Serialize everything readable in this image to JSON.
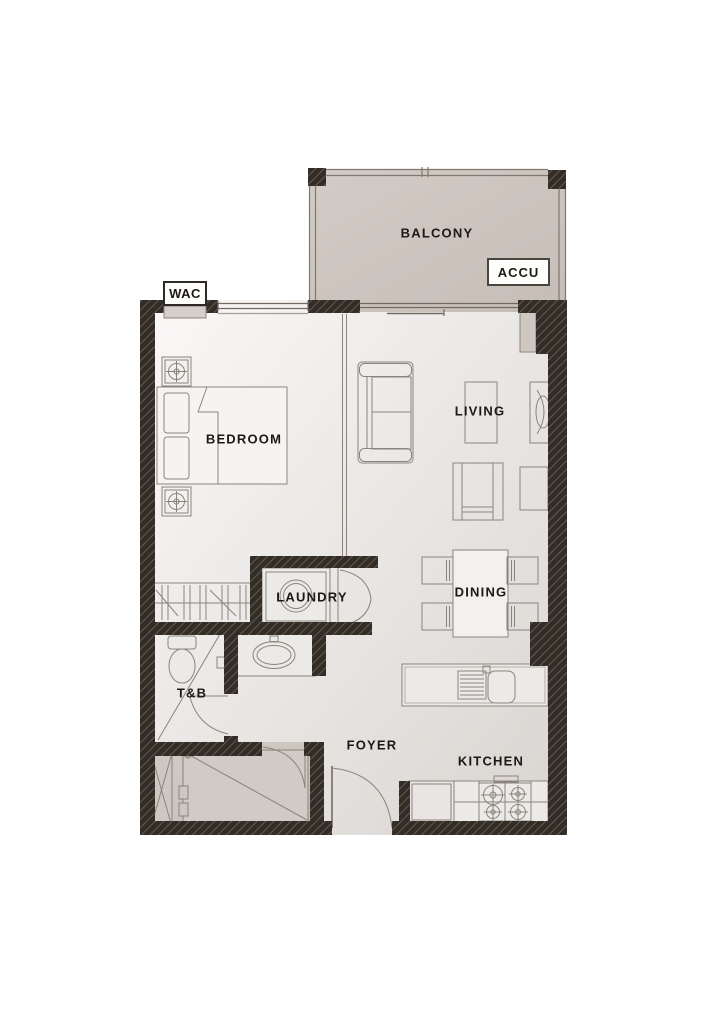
{
  "floor_plan": {
    "rooms": {
      "balcony": "BALCONY",
      "bedroom": "BEDROOM",
      "living": "LIVING",
      "dining": "DINING",
      "laundry": "LAUNDRY",
      "toilet_bath": "T&B",
      "foyer": "FOYER",
      "kitchen": "KITCHEN"
    },
    "equipment_tags": {
      "accu": "ACCU",
      "wac": "WAC"
    },
    "colors": {
      "background": "#ffffff",
      "wall": "#332d27",
      "wall_hatch_stripe": "#6a6055",
      "floor_light": "#faf9f8",
      "floor_shade": "#d8d4d0",
      "outdoor_beige": "#cdc4be",
      "furniture_line": "#8a847d",
      "label_text": "#1c1815"
    }
  }
}
